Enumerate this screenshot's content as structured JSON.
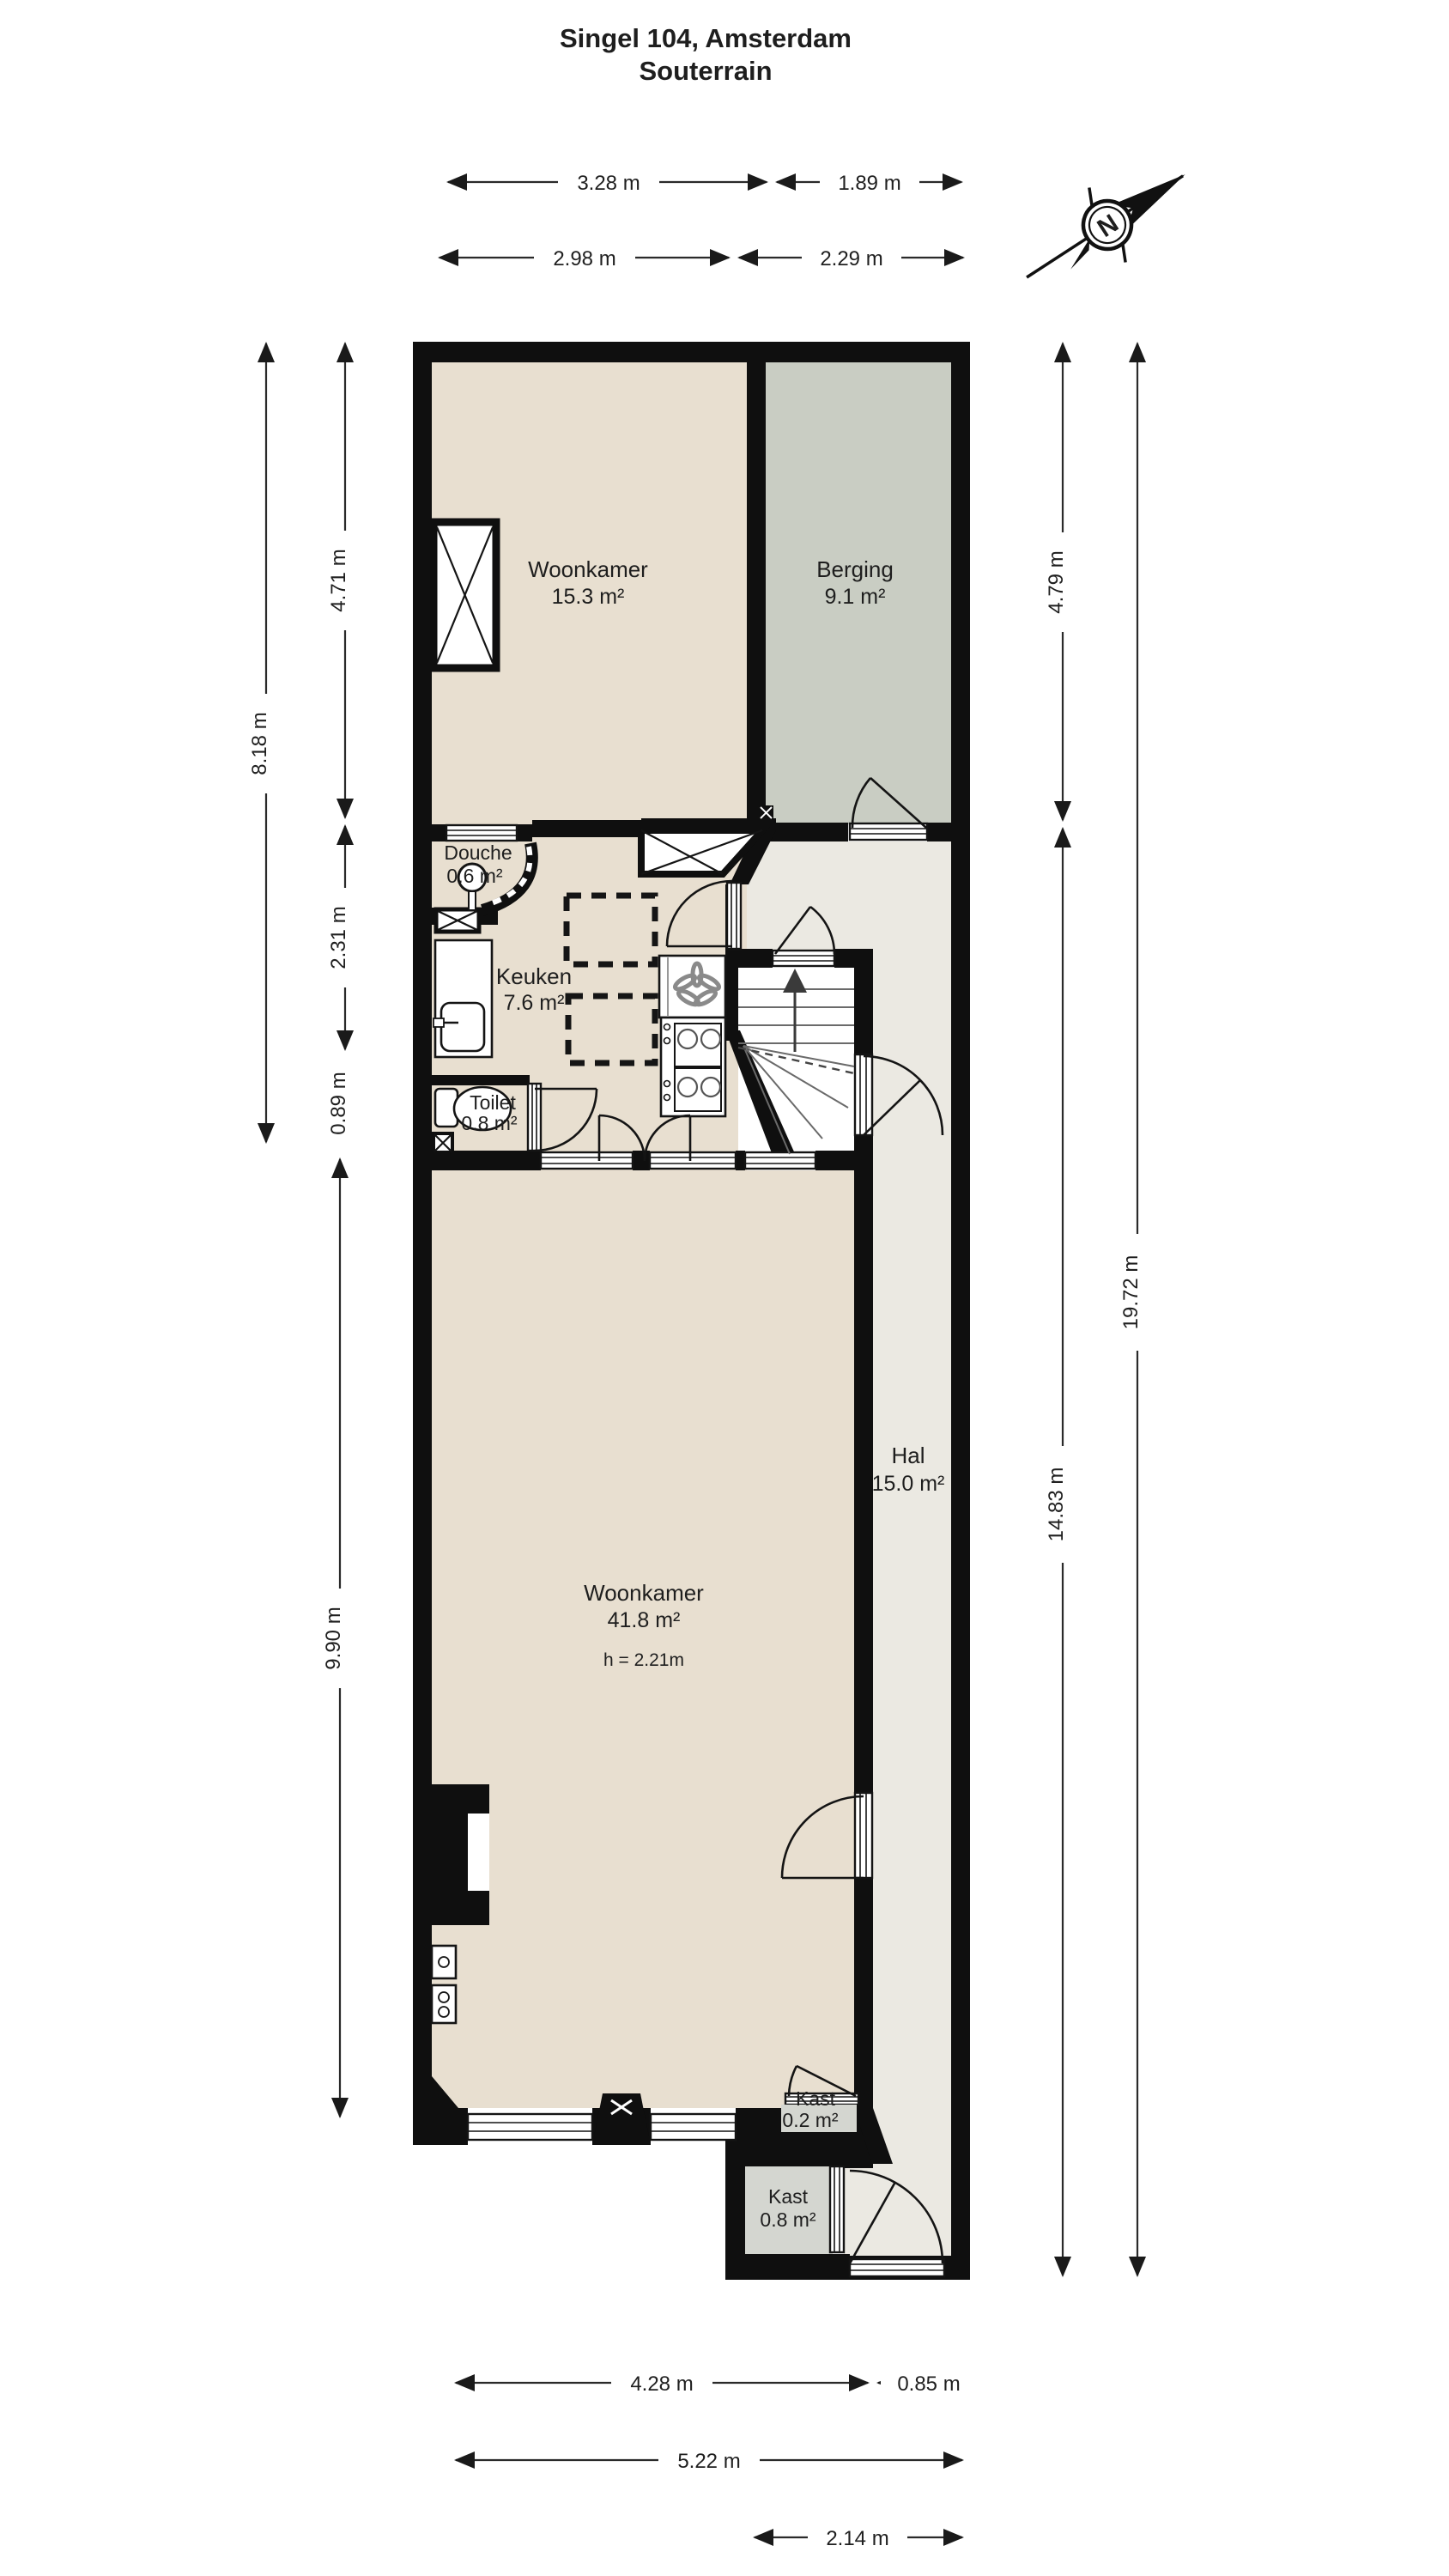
{
  "title": {
    "line1": "Singel 104, Amsterdam",
    "line2": "Souterrain"
  },
  "compass": {
    "north_label": "N"
  },
  "rooms": [
    {
      "name": "Woonkamer",
      "area": "15.3 m²"
    },
    {
      "name": "Berging",
      "area": "9.1 m²"
    },
    {
      "name": "Douche",
      "area": "0.6 m²"
    },
    {
      "name": "Keuken",
      "area": "7.6 m²"
    },
    {
      "name": "Toilet",
      "area": "0.8 m²"
    },
    {
      "name": "Hal",
      "area": "15.0 m²"
    },
    {
      "name": "Woonkamer",
      "area": "41.8 m²",
      "height_note": "h = 2.21m"
    },
    {
      "name": "Kast",
      "area": "0.2 m²"
    },
    {
      "name": "Kast",
      "area": "0.8 m²"
    }
  ],
  "dimensions": {
    "top_row1": [
      "3.28 m",
      "1.89 m"
    ],
    "top_row2": [
      "2.98 m",
      "2.29 m"
    ],
    "left": [
      "8.18 m",
      "4.71 m",
      "2.31 m",
      "0.89 m",
      "9.90 m"
    ],
    "right": [
      "4.79 m",
      "19.72 m",
      "14.83 m"
    ],
    "bottom_row1": [
      "4.28 m",
      "0.85 m"
    ],
    "bottom_row2": [
      "5.22 m"
    ],
    "bottom_row3": [
      "2.14 m"
    ]
  },
  "colors": {
    "wall": "#0f0f0f",
    "living_floor": "#e8dfd0",
    "storage_floor": "#c9cdc3",
    "hall_floor": "#ebe9e2",
    "closet_floor": "#d4d6d0",
    "background": "#ffffff"
  }
}
